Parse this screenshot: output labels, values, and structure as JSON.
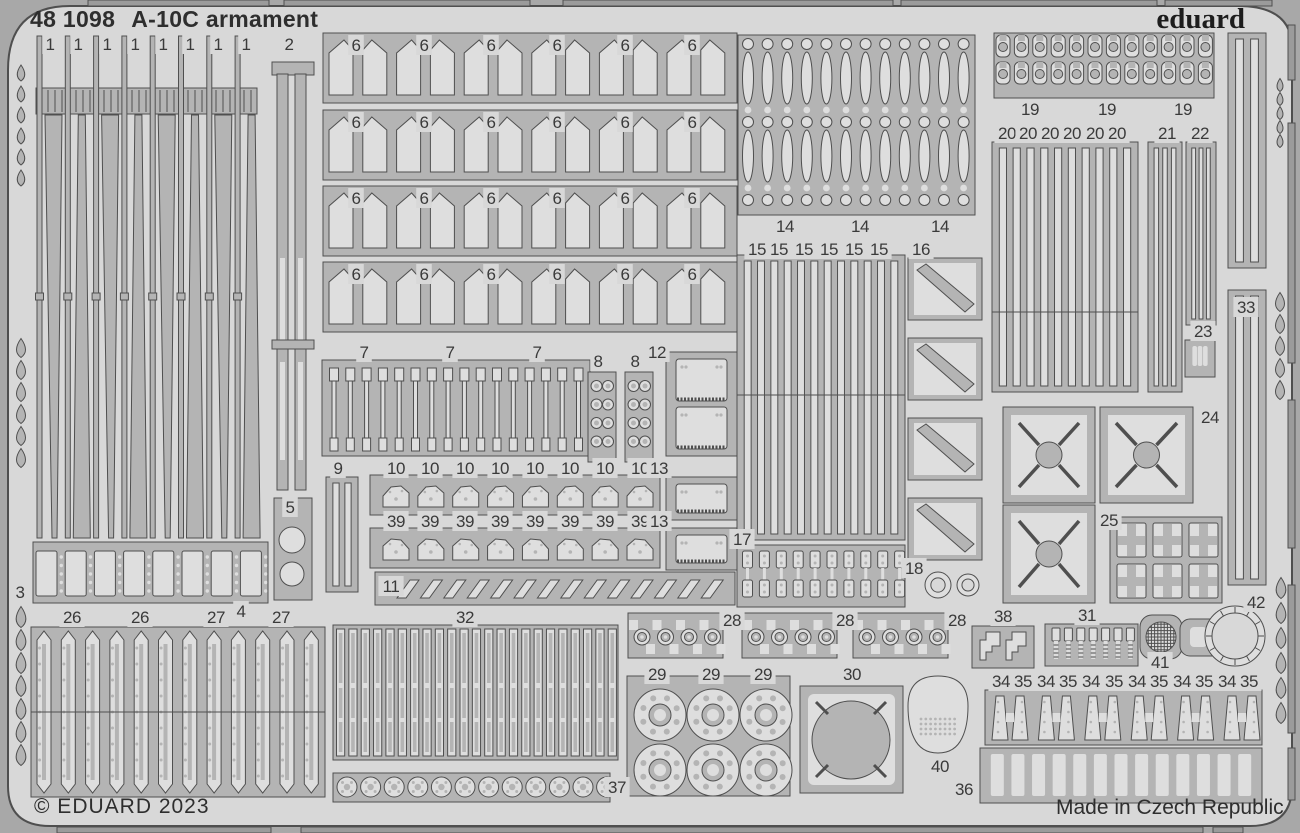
{
  "header": {
    "code": "48 1098",
    "name": "A-10C armament",
    "brand": "eduard"
  },
  "footer": {
    "copyright": "© EDUARD 2023",
    "origin": "Made in Czech Republic"
  },
  "colors": {
    "outer": "#a8a8a8",
    "fret": "#d8d8d8",
    "part": "#b4b4b4",
    "light": "#dedede",
    "outline": "#4f4f4f",
    "frame": "#9b9b9b",
    "text": "#3a3a3a"
  },
  "frame": {
    "top_bars": [
      [
        88,
        181
      ],
      [
        284,
        246
      ],
      [
        563,
        330
      ],
      [
        901,
        256
      ],
      [
        1165,
        107
      ]
    ],
    "bottom_bars": [
      [
        57,
        214
      ],
      [
        301,
        902
      ],
      [
        1213,
        30
      ]
    ],
    "right_rails": [
      [
        25,
        55
      ],
      [
        123,
        240
      ],
      [
        400,
        148
      ],
      [
        585,
        148
      ],
      [
        748,
        52
      ]
    ],
    "drops": [
      {
        "x": 21,
        "y0": 73,
        "n": 6,
        "s": 21,
        "w": 10,
        "h": 16
      },
      {
        "x": 21,
        "y0": 348,
        "n": 6,
        "s": 22,
        "w": 12,
        "h": 19
      },
      {
        "x": 21,
        "y0": 617,
        "n": 7,
        "s": 23,
        "w": 13,
        "h": 21
      },
      {
        "x": 1280,
        "y0": 85,
        "n": 5,
        "s": 14,
        "w": 8,
        "h": 13
      },
      {
        "x": 1280,
        "y0": 302,
        "n": 5,
        "s": 22,
        "w": 12,
        "h": 19
      },
      {
        "x": 1281,
        "y0": 588,
        "n": 6,
        "s": 25,
        "w": 13,
        "h": 21
      }
    ]
  },
  "groups": [
    {
      "id": "1",
      "type": "blades",
      "labels": [
        [
          "1",
          50,
          44
        ],
        [
          "1",
          78,
          44
        ],
        [
          "1",
          107,
          44
        ],
        [
          "1",
          135,
          44
        ],
        [
          "1",
          163,
          44
        ],
        [
          "1",
          190,
          44
        ],
        [
          "1",
          218,
          44
        ],
        [
          "1",
          246,
          44
        ]
      ]
    },
    {
      "id": "2",
      "type": "strips2",
      "labels": [
        [
          "2",
          289,
          44
        ]
      ]
    },
    {
      "id": "3",
      "type": "rectdots",
      "labels": [
        [
          "3",
          20,
          592
        ]
      ]
    },
    {
      "id": "5",
      "type": "plate5",
      "labels": [
        [
          "5",
          290,
          507
        ]
      ]
    },
    {
      "id": "26-27",
      "type": "block2627",
      "labels": [
        [
          "26",
          72,
          617
        ],
        [
          "26",
          140,
          617
        ],
        [
          "27",
          216,
          617
        ],
        [
          "4",
          241,
          611
        ],
        [
          "27",
          281,
          617
        ]
      ]
    },
    {
      "id": "6a",
      "type": "fins",
      "y": 33,
      "labels": [
        [
          "6",
          356,
          45
        ],
        [
          "6",
          424,
          45
        ],
        [
          "6",
          491,
          45
        ],
        [
          "6",
          557,
          45
        ],
        [
          "6",
          625,
          45
        ],
        [
          "6",
          692,
          45
        ]
      ]
    },
    {
      "id": "6b",
      "type": "fins",
      "y": 110,
      "labels": [
        [
          "6",
          356,
          122
        ],
        [
          "6",
          424,
          122
        ],
        [
          "6",
          491,
          122
        ],
        [
          "6",
          557,
          122
        ],
        [
          "6",
          625,
          122
        ],
        [
          "6",
          692,
          122
        ]
      ]
    },
    {
      "id": "6c",
      "type": "fins",
      "y": 186,
      "labels": [
        [
          "6",
          356,
          198
        ],
        [
          "6",
          424,
          198
        ],
        [
          "6",
          491,
          198
        ],
        [
          "6",
          557,
          198
        ],
        [
          "6",
          625,
          198
        ],
        [
          "6",
          692,
          198
        ]
      ]
    },
    {
      "id": "6d",
      "type": "fins",
      "y": 262,
      "labels": [
        [
          "6",
          356,
          274
        ],
        [
          "6",
          424,
          274
        ],
        [
          "6",
          491,
          274
        ],
        [
          "6",
          557,
          274
        ],
        [
          "6",
          625,
          274
        ],
        [
          "6",
          692,
          274
        ]
      ]
    },
    {
      "id": "7",
      "type": "dumb",
      "labels": [
        [
          "7",
          364,
          352
        ],
        [
          "7",
          450,
          352
        ],
        [
          "7",
          537,
          352
        ]
      ]
    },
    {
      "id": "8",
      "type": "plates8",
      "labels": [
        [
          "8",
          598,
          361
        ],
        [
          "8",
          635,
          361
        ]
      ]
    },
    {
      "id": "12",
      "type": "platepl",
      "x": 666,
      "y": 352,
      "w": 71,
      "h": 104,
      "n": 2,
      "labels": [
        [
          "12",
          657,
          352
        ]
      ]
    },
    {
      "id": "9",
      "type": "vstrips",
      "x": 326,
      "y": 477,
      "w": 32,
      "h": 115,
      "n": 2,
      "labels": [
        [
          "9",
          338,
          468
        ]
      ]
    },
    {
      "id": "10",
      "type": "mechrow",
      "y": 475,
      "flip": false,
      "labels": [
        [
          "10",
          396,
          468
        ],
        [
          "10",
          430,
          468
        ],
        [
          "10",
          465,
          468
        ],
        [
          "10",
          500,
          468
        ],
        [
          "10",
          535,
          468
        ],
        [
          "10",
          570,
          468
        ],
        [
          "10",
          605,
          468
        ],
        [
          "10",
          640,
          468
        ]
      ]
    },
    {
      "id": "13a",
      "type": "platepl",
      "x": 666,
      "y": 477,
      "w": 71,
      "h": 43,
      "n": 1,
      "labels": [
        [
          "13",
          659,
          468
        ]
      ]
    },
    {
      "id": "39",
      "type": "mechrow",
      "y": 528,
      "flip": true,
      "labels": [
        [
          "39",
          396,
          521
        ],
        [
          "39",
          430,
          521
        ],
        [
          "39",
          465,
          521
        ],
        [
          "39",
          500,
          521
        ],
        [
          "39",
          535,
          521
        ],
        [
          "39",
          570,
          521
        ],
        [
          "39",
          605,
          521
        ],
        [
          "39",
          640,
          521
        ]
      ]
    },
    {
      "id": "13b",
      "type": "platepl",
      "x": 666,
      "y": 528,
      "w": 71,
      "h": 42,
      "n": 1,
      "labels": [
        [
          "13",
          659,
          521
        ]
      ]
    },
    {
      "id": "11",
      "type": "pgrams",
      "labels": [
        [
          "11",
          391,
          586
        ]
      ]
    },
    {
      "id": "32",
      "type": "slots32",
      "labels": [
        [
          "32",
          465,
          617
        ]
      ]
    },
    {
      "id": "37",
      "type": "gears",
      "labels": [
        [
          "37",
          617,
          787
        ]
      ]
    },
    {
      "id": "14",
      "type": "ovals",
      "labels": [
        [
          "14",
          785,
          226
        ],
        [
          "14",
          860,
          226
        ],
        [
          "14",
          940,
          226
        ]
      ]
    },
    {
      "id": "15",
      "type": "vstrips",
      "x": 737,
      "y": 255,
      "w": 168,
      "h": 285,
      "n": 12,
      "split": 395,
      "labels": [
        [
          "15",
          757,
          249
        ],
        [
          "15",
          779,
          249
        ],
        [
          "15",
          804,
          249
        ],
        [
          "15",
          829,
          249
        ],
        [
          "15",
          854,
          249
        ],
        [
          "15",
          879,
          249
        ]
      ]
    },
    {
      "id": "16",
      "type": "diag16",
      "ys": [
        258,
        338,
        418,
        498
      ],
      "labels": [
        [
          "16",
          921,
          249
        ]
      ]
    },
    {
      "id": "17",
      "type": "links",
      "labels": [
        [
          "17",
          742,
          539
        ]
      ]
    },
    {
      "id": "18",
      "type": "rings",
      "list": [
        [
          938,
          585,
          13
        ],
        [
          968,
          585,
          11
        ]
      ],
      "labels": [
        [
          "18",
          914,
          568
        ]
      ]
    },
    {
      "id": "19",
      "type": "buckles",
      "labels": [
        [
          "19",
          1030,
          109
        ],
        [
          "19",
          1107,
          109
        ],
        [
          "19",
          1183,
          109
        ]
      ]
    },
    {
      "id": "20",
      "type": "vstrips",
      "x": 992,
      "y": 142,
      "w": 146,
      "h": 250,
      "n": 10,
      "split": 312,
      "labels": [
        [
          "20",
          1007,
          133
        ],
        [
          "20",
          1028,
          133
        ],
        [
          "20",
          1050,
          133
        ],
        [
          "20",
          1072,
          133
        ],
        [
          "20",
          1095,
          133
        ],
        [
          "20",
          1117,
          133
        ]
      ]
    },
    {
      "id": "21",
      "type": "vstrips",
      "x": 1148,
      "y": 142,
      "w": 34,
      "h": 250,
      "n": 3,
      "labels": [
        [
          "21",
          1167,
          133
        ]
      ]
    },
    {
      "id": "22",
      "type": "vstrips",
      "x": 1186,
      "y": 142,
      "w": 30,
      "h": 183,
      "n": 3,
      "labels": [
        [
          "22",
          1200,
          133
        ]
      ]
    },
    {
      "id": "23",
      "type": "comb",
      "x": 1185,
      "y": 340,
      "w": 30,
      "h": 37,
      "n": 3,
      "tw": 4.6,
      "th": 20,
      "labels": [
        [
          "23",
          1203,
          331
        ]
      ]
    },
    {
      "id": "24",
      "type": "xsq",
      "list": [
        [
          1003,
          407,
          92,
          96
        ],
        [
          1100,
          407,
          93,
          96
        ],
        [
          1003,
          505,
          92,
          98
        ]
      ],
      "labels": [
        [
          "24",
          1210,
          417
        ]
      ]
    },
    {
      "id": "25",
      "type": "frames25",
      "labels": [
        [
          "25",
          1109,
          520
        ]
      ]
    },
    {
      "id": "33",
      "type": "vstrips",
      "x": 1228,
      "y": 33,
      "w": 38,
      "h": 235,
      "n": 2,
      "labels": [
        [
          "33",
          1246,
          307
        ]
      ]
    },
    {
      "id": "33b",
      "type": "vstrips",
      "x": 1228,
      "y": 290,
      "w": 38,
      "h": 295,
      "n": 2,
      "labels": []
    },
    {
      "id": "28",
      "type": "grom",
      "xs": [
        628,
        742,
        853
      ],
      "labels": [
        [
          "28",
          732,
          620
        ],
        [
          "28",
          845,
          620
        ],
        [
          "28",
          957,
          620
        ]
      ]
    },
    {
      "id": "29",
      "type": "discs",
      "labels": [
        [
          "29",
          657,
          674
        ],
        [
          "29",
          711,
          674
        ],
        [
          "29",
          763,
          674
        ]
      ]
    },
    {
      "id": "30",
      "type": "plate30",
      "labels": [
        [
          "30",
          852,
          674
        ]
      ]
    },
    {
      "id": "40",
      "type": "dome",
      "labels": [
        [
          "40",
          940,
          766
        ]
      ]
    },
    {
      "id": "38",
      "type": "bracket",
      "labels": [
        [
          "38",
          1003,
          616
        ]
      ]
    },
    {
      "id": "31",
      "type": "bolts",
      "labels": [
        [
          "31",
          1087,
          615
        ]
      ]
    },
    {
      "id": "41",
      "type": "mesh41",
      "labels": [
        [
          "41",
          1160,
          662
        ]
      ]
    },
    {
      "id": "42",
      "type": "ring42",
      "labels": [
        [
          "42",
          1256,
          602
        ]
      ]
    },
    {
      "id": "34-35",
      "type": "cones",
      "labels": [
        [
          "34",
          1001,
          681
        ],
        [
          "35",
          1023,
          681
        ],
        [
          "34",
          1046,
          681
        ],
        [
          "35",
          1068,
          681
        ],
        [
          "34",
          1091,
          681
        ],
        [
          "35",
          1114,
          681
        ],
        [
          "34",
          1137,
          681
        ],
        [
          "35",
          1159,
          681
        ],
        [
          "34",
          1182,
          681
        ],
        [
          "35",
          1204,
          681
        ],
        [
          "34",
          1227,
          681
        ],
        [
          "35",
          1249,
          681
        ]
      ]
    },
    {
      "id": "36",
      "type": "comb",
      "x": 980,
      "y": 748,
      "w": 282,
      "h": 55,
      "n": 13,
      "tw": 13,
      "th": 42,
      "labels": [
        [
          "36",
          964,
          789
        ]
      ]
    }
  ]
}
